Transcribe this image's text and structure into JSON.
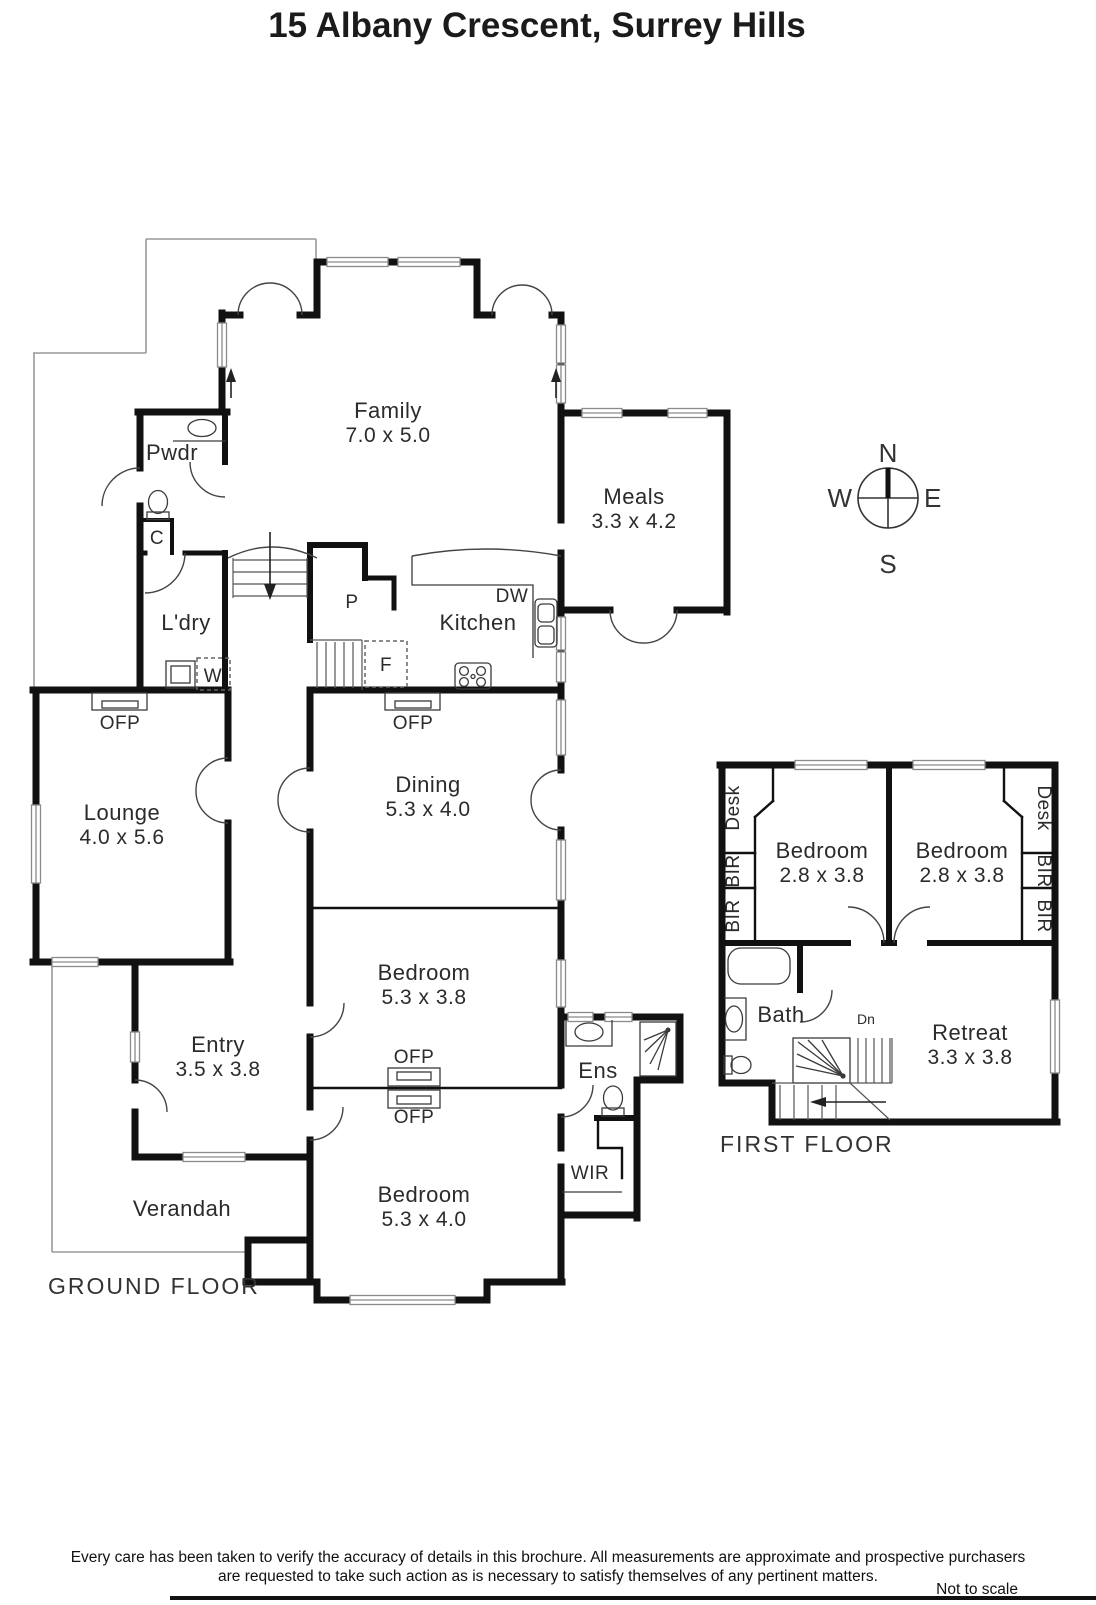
{
  "title": "15 Albany Crescent, Surrey Hills",
  "compass": {
    "n": "N",
    "e": "E",
    "s": "S",
    "w": "W"
  },
  "colors": {
    "wall": "#111111",
    "window": "#8a8a8a",
    "outline": "#999999",
    "text": "#2b2b2b"
  },
  "ground": {
    "label": "GROUND FLOOR",
    "rooms": {
      "family": {
        "name": "Family",
        "dims": "7.0 x 5.0"
      },
      "meals": {
        "name": "Meals",
        "dims": "3.3 x 4.2"
      },
      "lounge": {
        "name": "Lounge",
        "dims": "4.0 x 5.6"
      },
      "dining": {
        "name": "Dining",
        "dims": "5.3 x 4.0"
      },
      "bedroom1": {
        "name": "Bedroom",
        "dims": "5.3 x 3.8"
      },
      "bedroom2": {
        "name": "Bedroom",
        "dims": "5.3 x 4.0"
      },
      "entry": {
        "name": "Entry",
        "dims": "3.5 x 3.8"
      },
      "kitchen": {
        "name": "Kitchen"
      },
      "pwdr": {
        "name": "Pwdr"
      },
      "ldry": {
        "name": "L'dry"
      },
      "ens": {
        "name": "Ens"
      },
      "wir": {
        "name": "WIR"
      },
      "verandah": {
        "name": "Verandah"
      }
    },
    "features": {
      "ofp": "OFP",
      "dw": "DW",
      "pantry": "P",
      "fridge": "F",
      "washer": "W",
      "cupboard": "C"
    }
  },
  "first": {
    "label": "FIRST FLOOR",
    "rooms": {
      "bedroomLeft": {
        "name": "Bedroom",
        "dims": "2.8 x 3.8"
      },
      "bedroomRight": {
        "name": "Bedroom",
        "dims": "2.8 x 3.8"
      },
      "bath": {
        "name": "Bath"
      },
      "retreat": {
        "name": "Retreat",
        "dims": "3.3 x 3.8"
      }
    },
    "features": {
      "desk": "Desk",
      "bir": "BIR",
      "down": "Dn"
    }
  },
  "footer": {
    "line1": "Every care has been taken to verify the accuracy of details in this brochure.  All measurements are approximate and prospective purchasers",
    "line2": "are requested to take such action as is necessary to satisfy themselves of any pertinent matters.",
    "scale": "Not to scale"
  }
}
